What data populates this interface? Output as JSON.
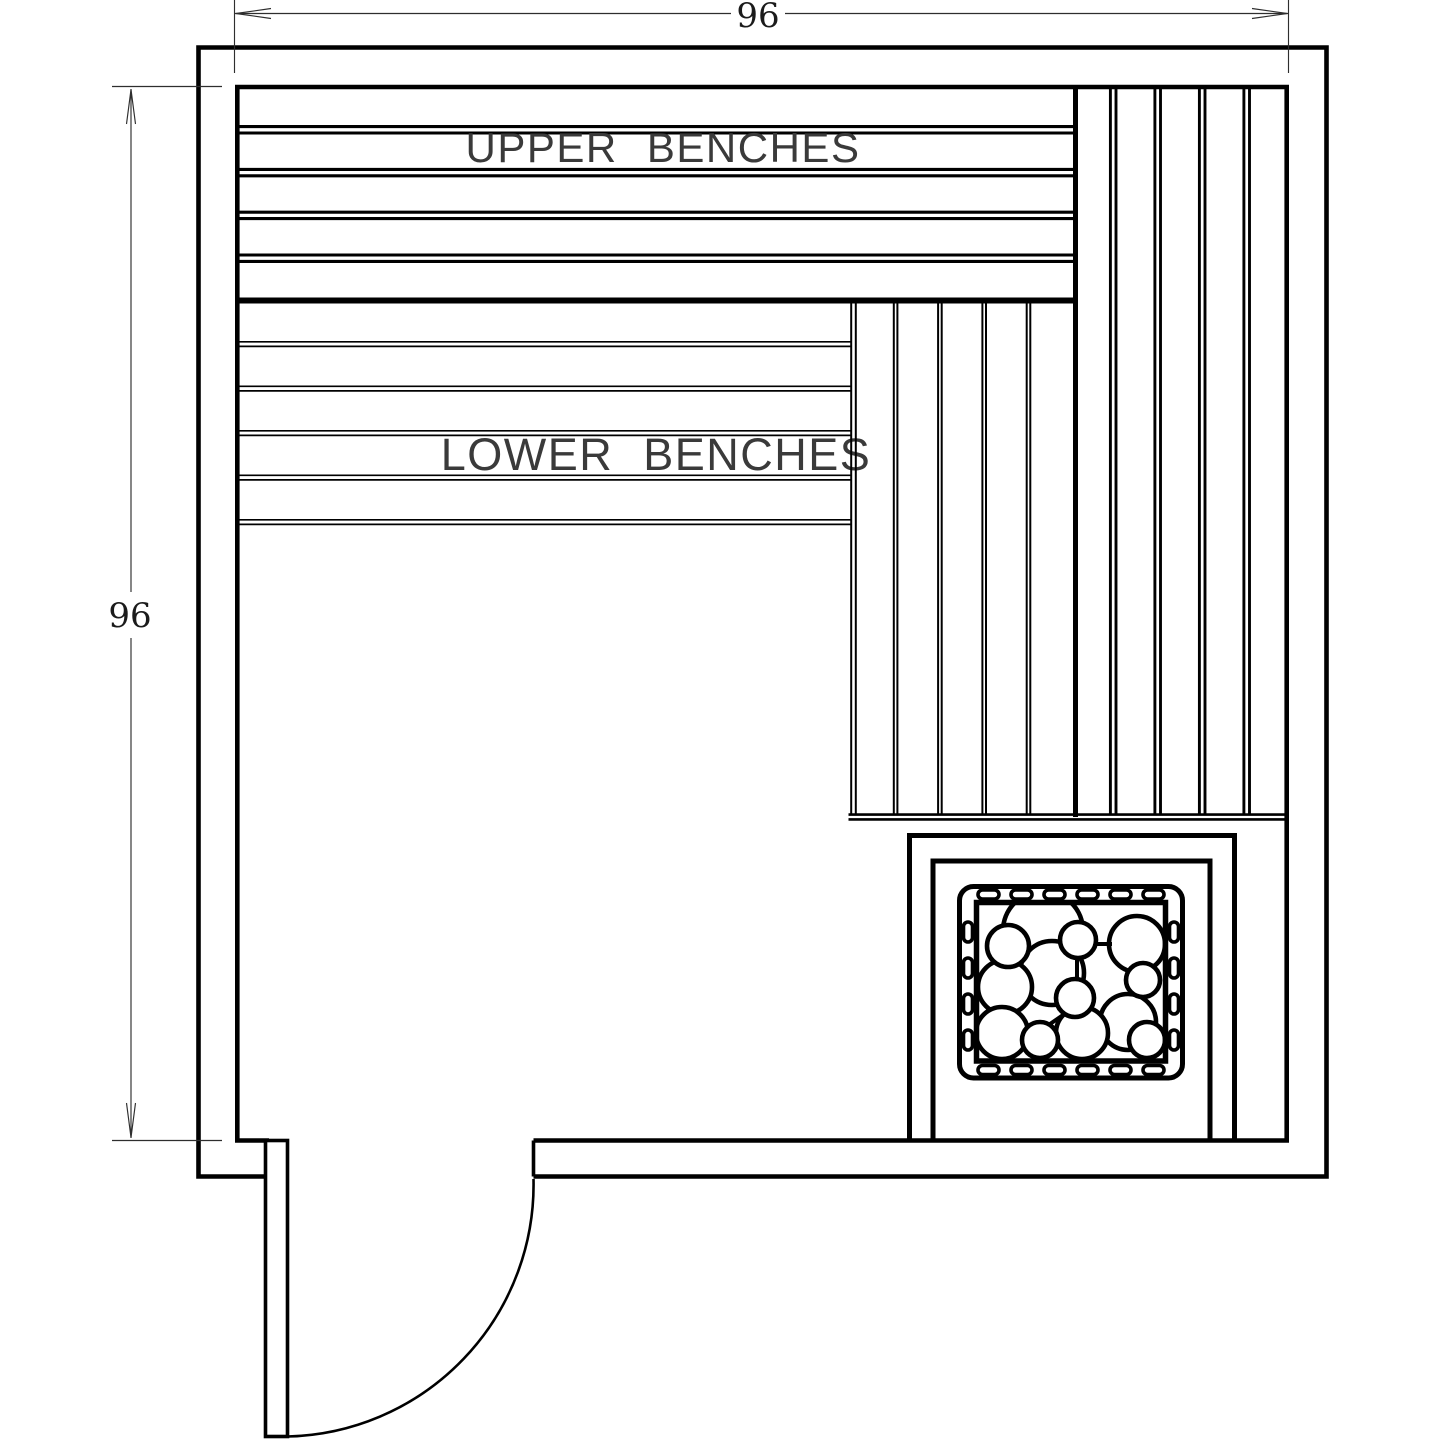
{
  "labels": {
    "upper_benches": "UPPER BENCHES",
    "lower_benches": "LOWER BENCHES"
  },
  "dimensions": {
    "width": {
      "value": "96"
    },
    "height": {
      "value": "96"
    }
  },
  "colors": {
    "line": "#000000",
    "dimension_line": "#2e2e2e",
    "text": "#1b1b1b",
    "background": "#ffffff"
  }
}
